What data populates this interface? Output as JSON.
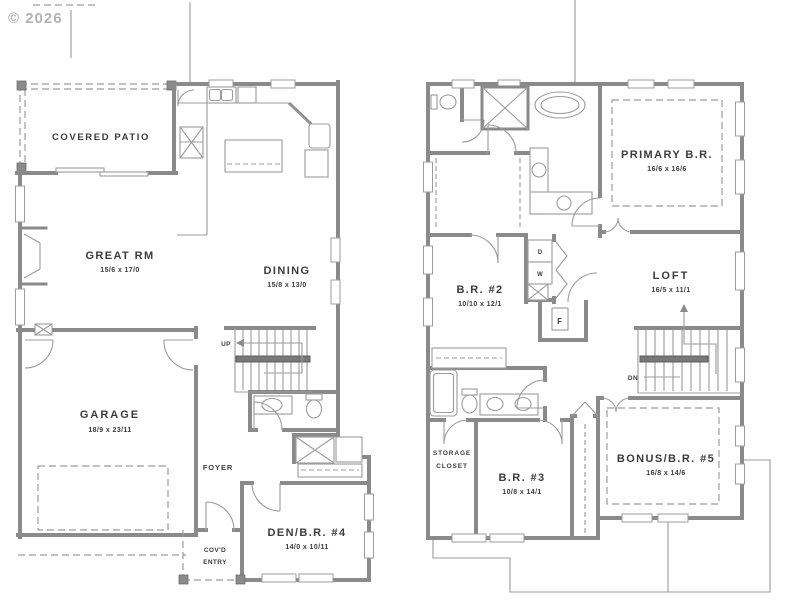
{
  "watermark": "© 2026",
  "colors": {
    "wall": "#8a8a8a",
    "thin_line": "#9c9c9c",
    "text": "#3c3c3c",
    "watermark": "#b3b3b3",
    "background": "#ffffff"
  },
  "first_floor": {
    "covered_patio": "COVERED PATIO",
    "great_rm": "GREAT RM",
    "great_rm_dims": "15/6 x 17/0",
    "dining": "DINING",
    "dining_dims": "15/8 x 13/0",
    "garage": "GARAGE",
    "garage_dims": "18/9 x 23/11",
    "stairs": "UP",
    "foyer": "FOYER",
    "covd_entry_1": "COV'D",
    "covd_entry_2": "ENTRY",
    "den": "DEN/B.R. #4",
    "den_dims": "14/0 x 10/11"
  },
  "second_floor": {
    "primary": "PRIMARY B.R.",
    "primary_dims": "16/6 x 16/6",
    "br2": "B.R. #2",
    "br2_dims": "10/10 x 12/1",
    "loft": "LOFT",
    "loft_dims": "16/5 x 11/1",
    "storage_1": "STORAGE",
    "storage_2": "CLOSET",
    "br3": "B.R. #3",
    "br3_dims": "10/8 x 14/1",
    "bonus": "BONUS/B.R. #5",
    "bonus_dims": "16/8 x 14/6",
    "stairs": "DN",
    "dryer": "D",
    "washer": "W",
    "furnace": "F"
  }
}
